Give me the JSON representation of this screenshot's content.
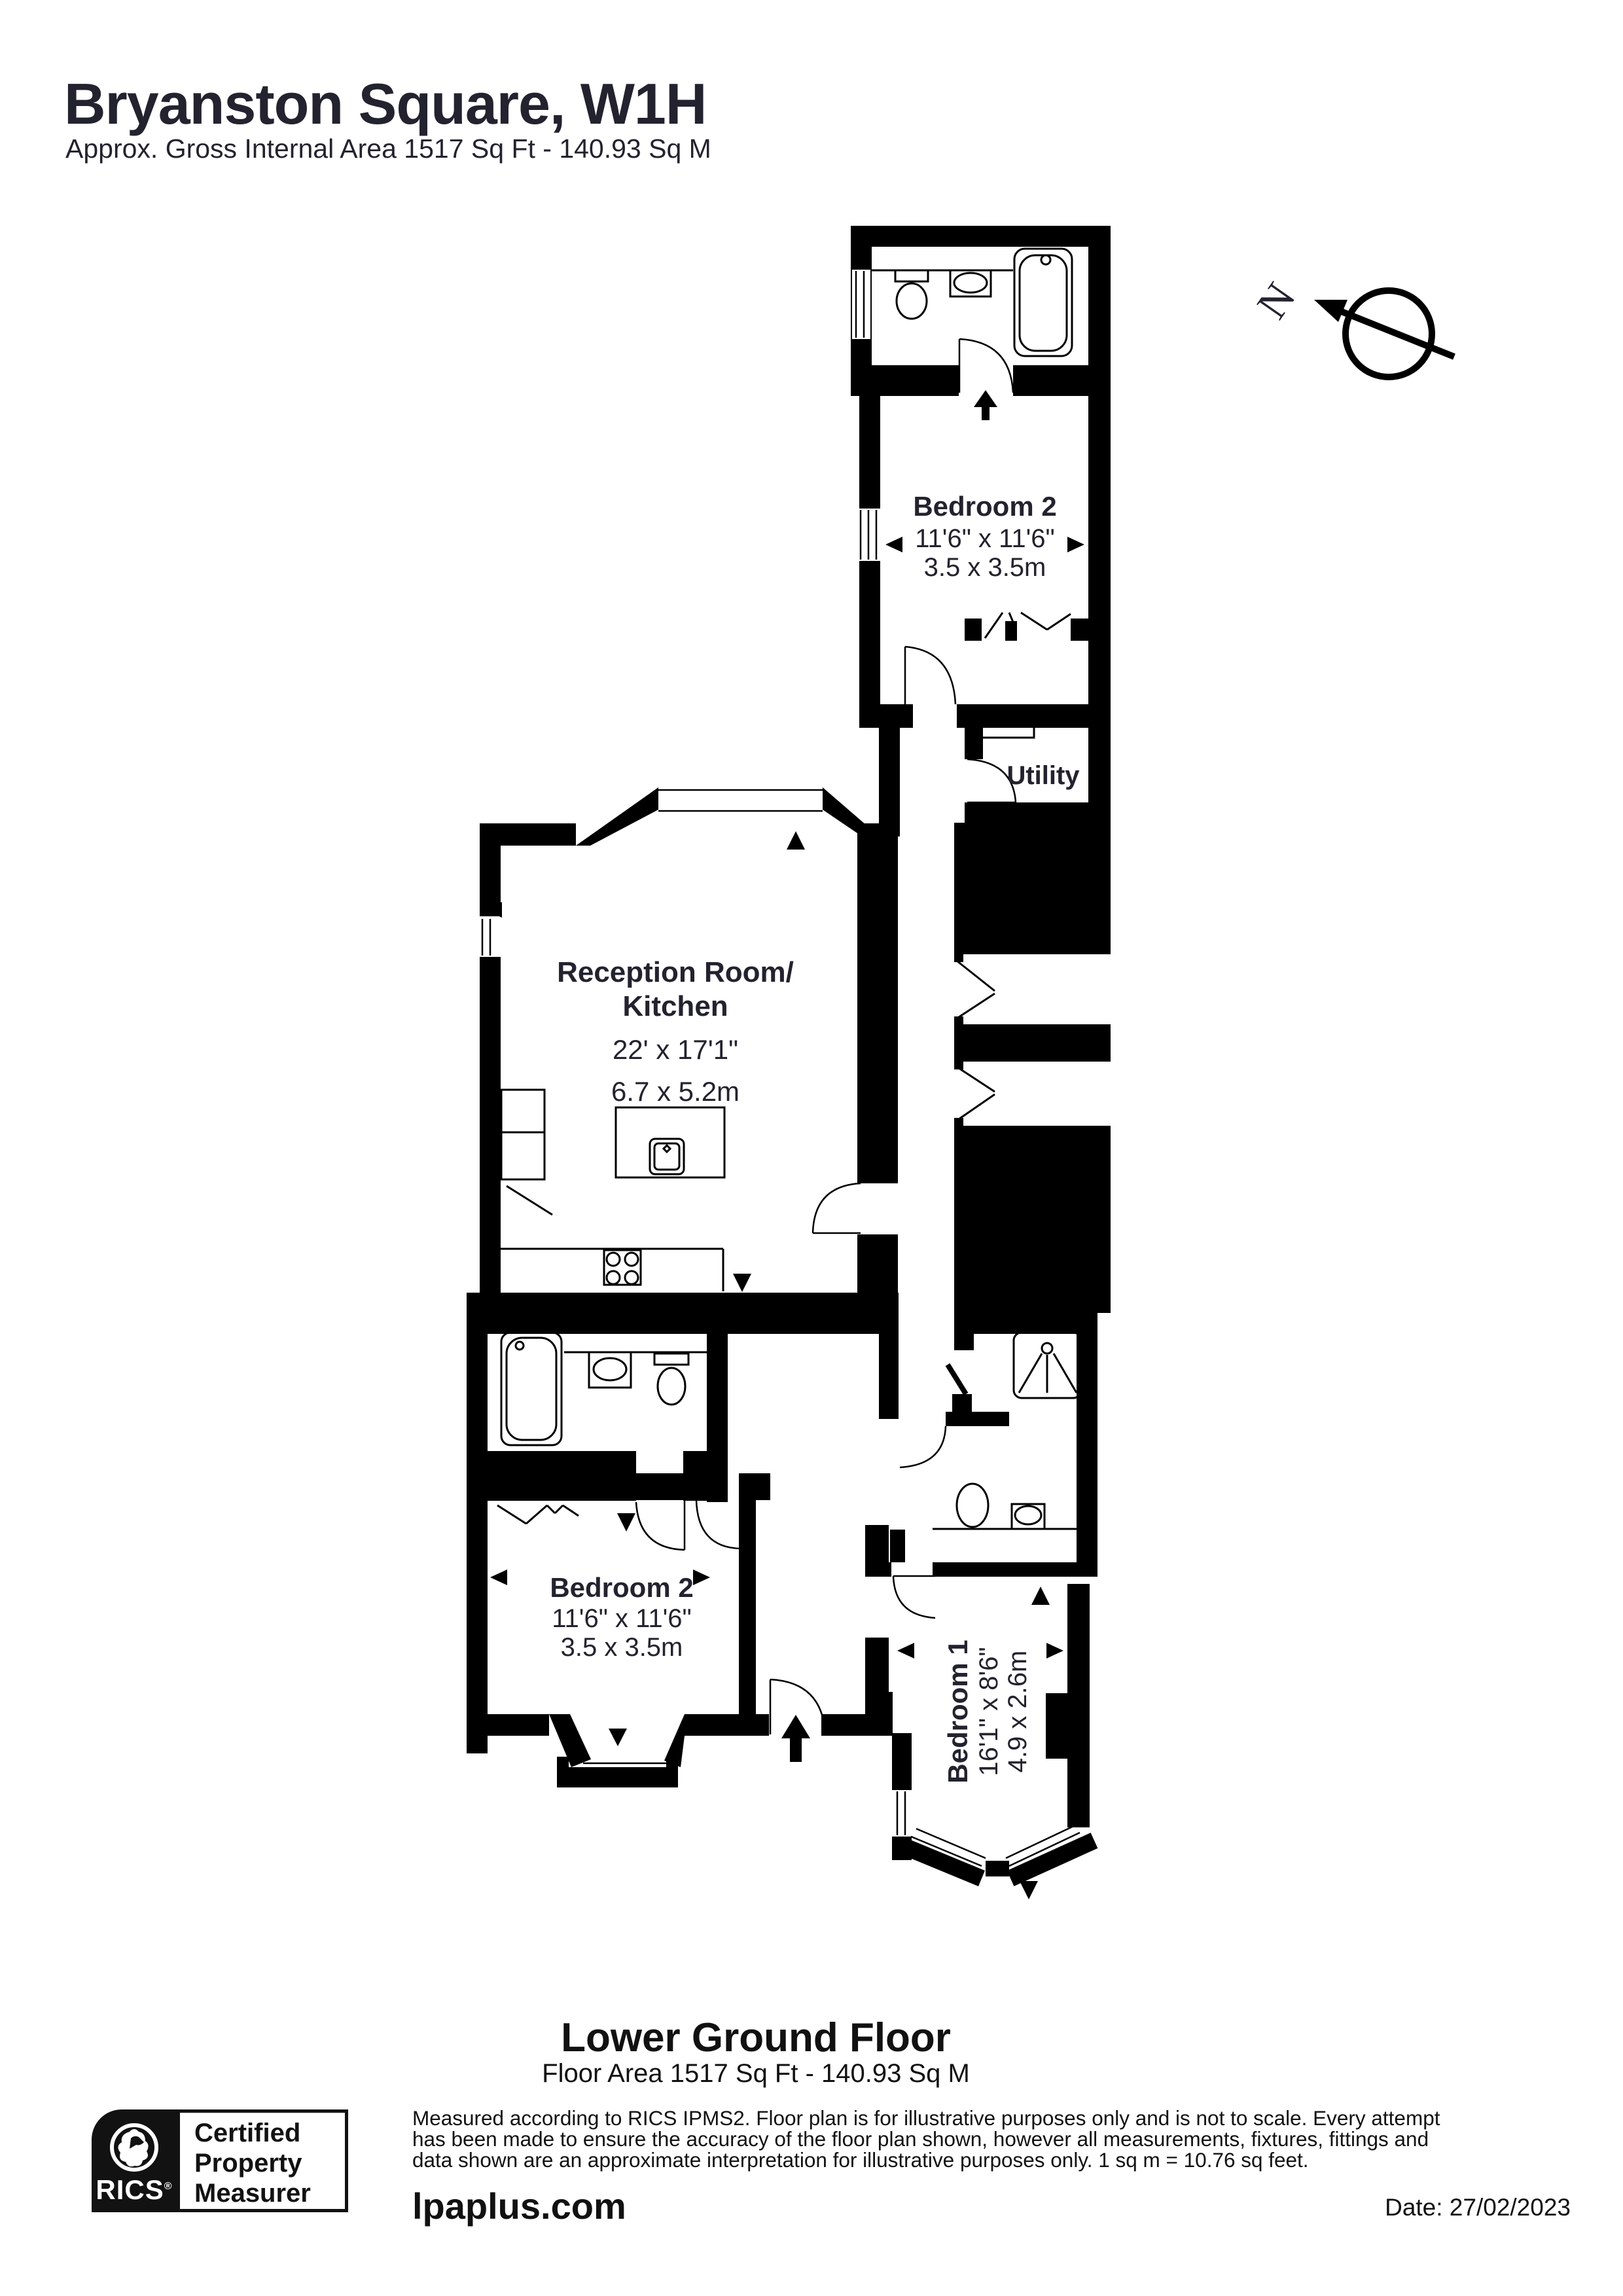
{
  "header": {
    "title": "Bryanston Square, W1H",
    "subtitle": "Approx. Gross Internal Area 1517 Sq Ft - 140.93 Sq M"
  },
  "compass": {
    "north": "N"
  },
  "rooms": {
    "bedroom2_top": {
      "name": "Bedroom 2",
      "imperial": "11'6\" x 11'6\"",
      "metric": "3.5 x 3.5m"
    },
    "utility": {
      "name": "Utility"
    },
    "reception": {
      "line1": "Reception Room/",
      "line2": "Kitchen",
      "imperial": "22' x 17'1\"",
      "metric": "6.7 x 5.2m"
    },
    "bedroom2_lower": {
      "name": "Bedroom 2",
      "imperial": "11'6\" x 11'6\"",
      "metric": "3.5 x 3.5m"
    },
    "bedroom1": {
      "name": "Bedroom 1",
      "imperial": "16'1\" x 8'6\"",
      "metric": "4.9 x 2.6m"
    }
  },
  "footer": {
    "floor_name": "Lower Ground Floor",
    "floor_area": "Floor Area 1517 Sq Ft - 140.93 Sq M",
    "disclaimer_line1": "Measured according to RICS IPMS2. Floor plan is for illustrative purposes only and is not to scale. Every attempt",
    "disclaimer_line2": "has been made to ensure the accuracy of the floor plan shown, however all measurements, fixtures, fittings and",
    "disclaimer_line3": "data shown are an approximate interpretation for illustrative purposes only. 1 sq m = 10.76 sq feet.",
    "website": "lpaplus.com",
    "date": "Date: 27/02/2023"
  },
  "badge": {
    "org": "RICS",
    "reg": "®",
    "line1": "Certified",
    "line2": "Property",
    "line3": "Measurer"
  }
}
